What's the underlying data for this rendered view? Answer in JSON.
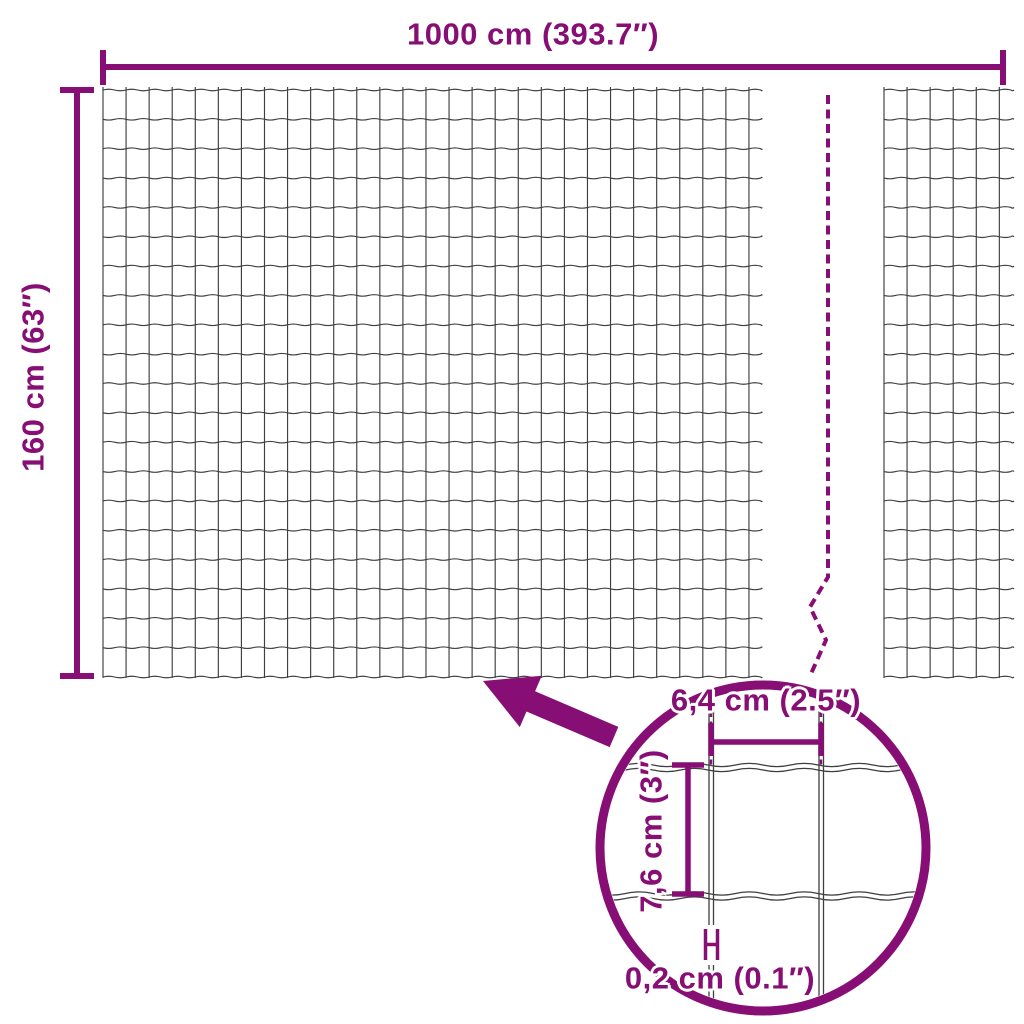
{
  "colors": {
    "accent": "#870E74",
    "wire": "#3F3F3F",
    "background": "#FFFFFF"
  },
  "dimension_labels": {
    "total_width": "1000 cm (393.7″)",
    "total_height": "160 cm (63″)"
  },
  "detail_labels": {
    "mesh_opening_width": "6,4 cm (2.5″)",
    "mesh_opening_height": "7,6 cm (3″)",
    "wire_thickness": "0,2 cm (0.1″)"
  }
}
